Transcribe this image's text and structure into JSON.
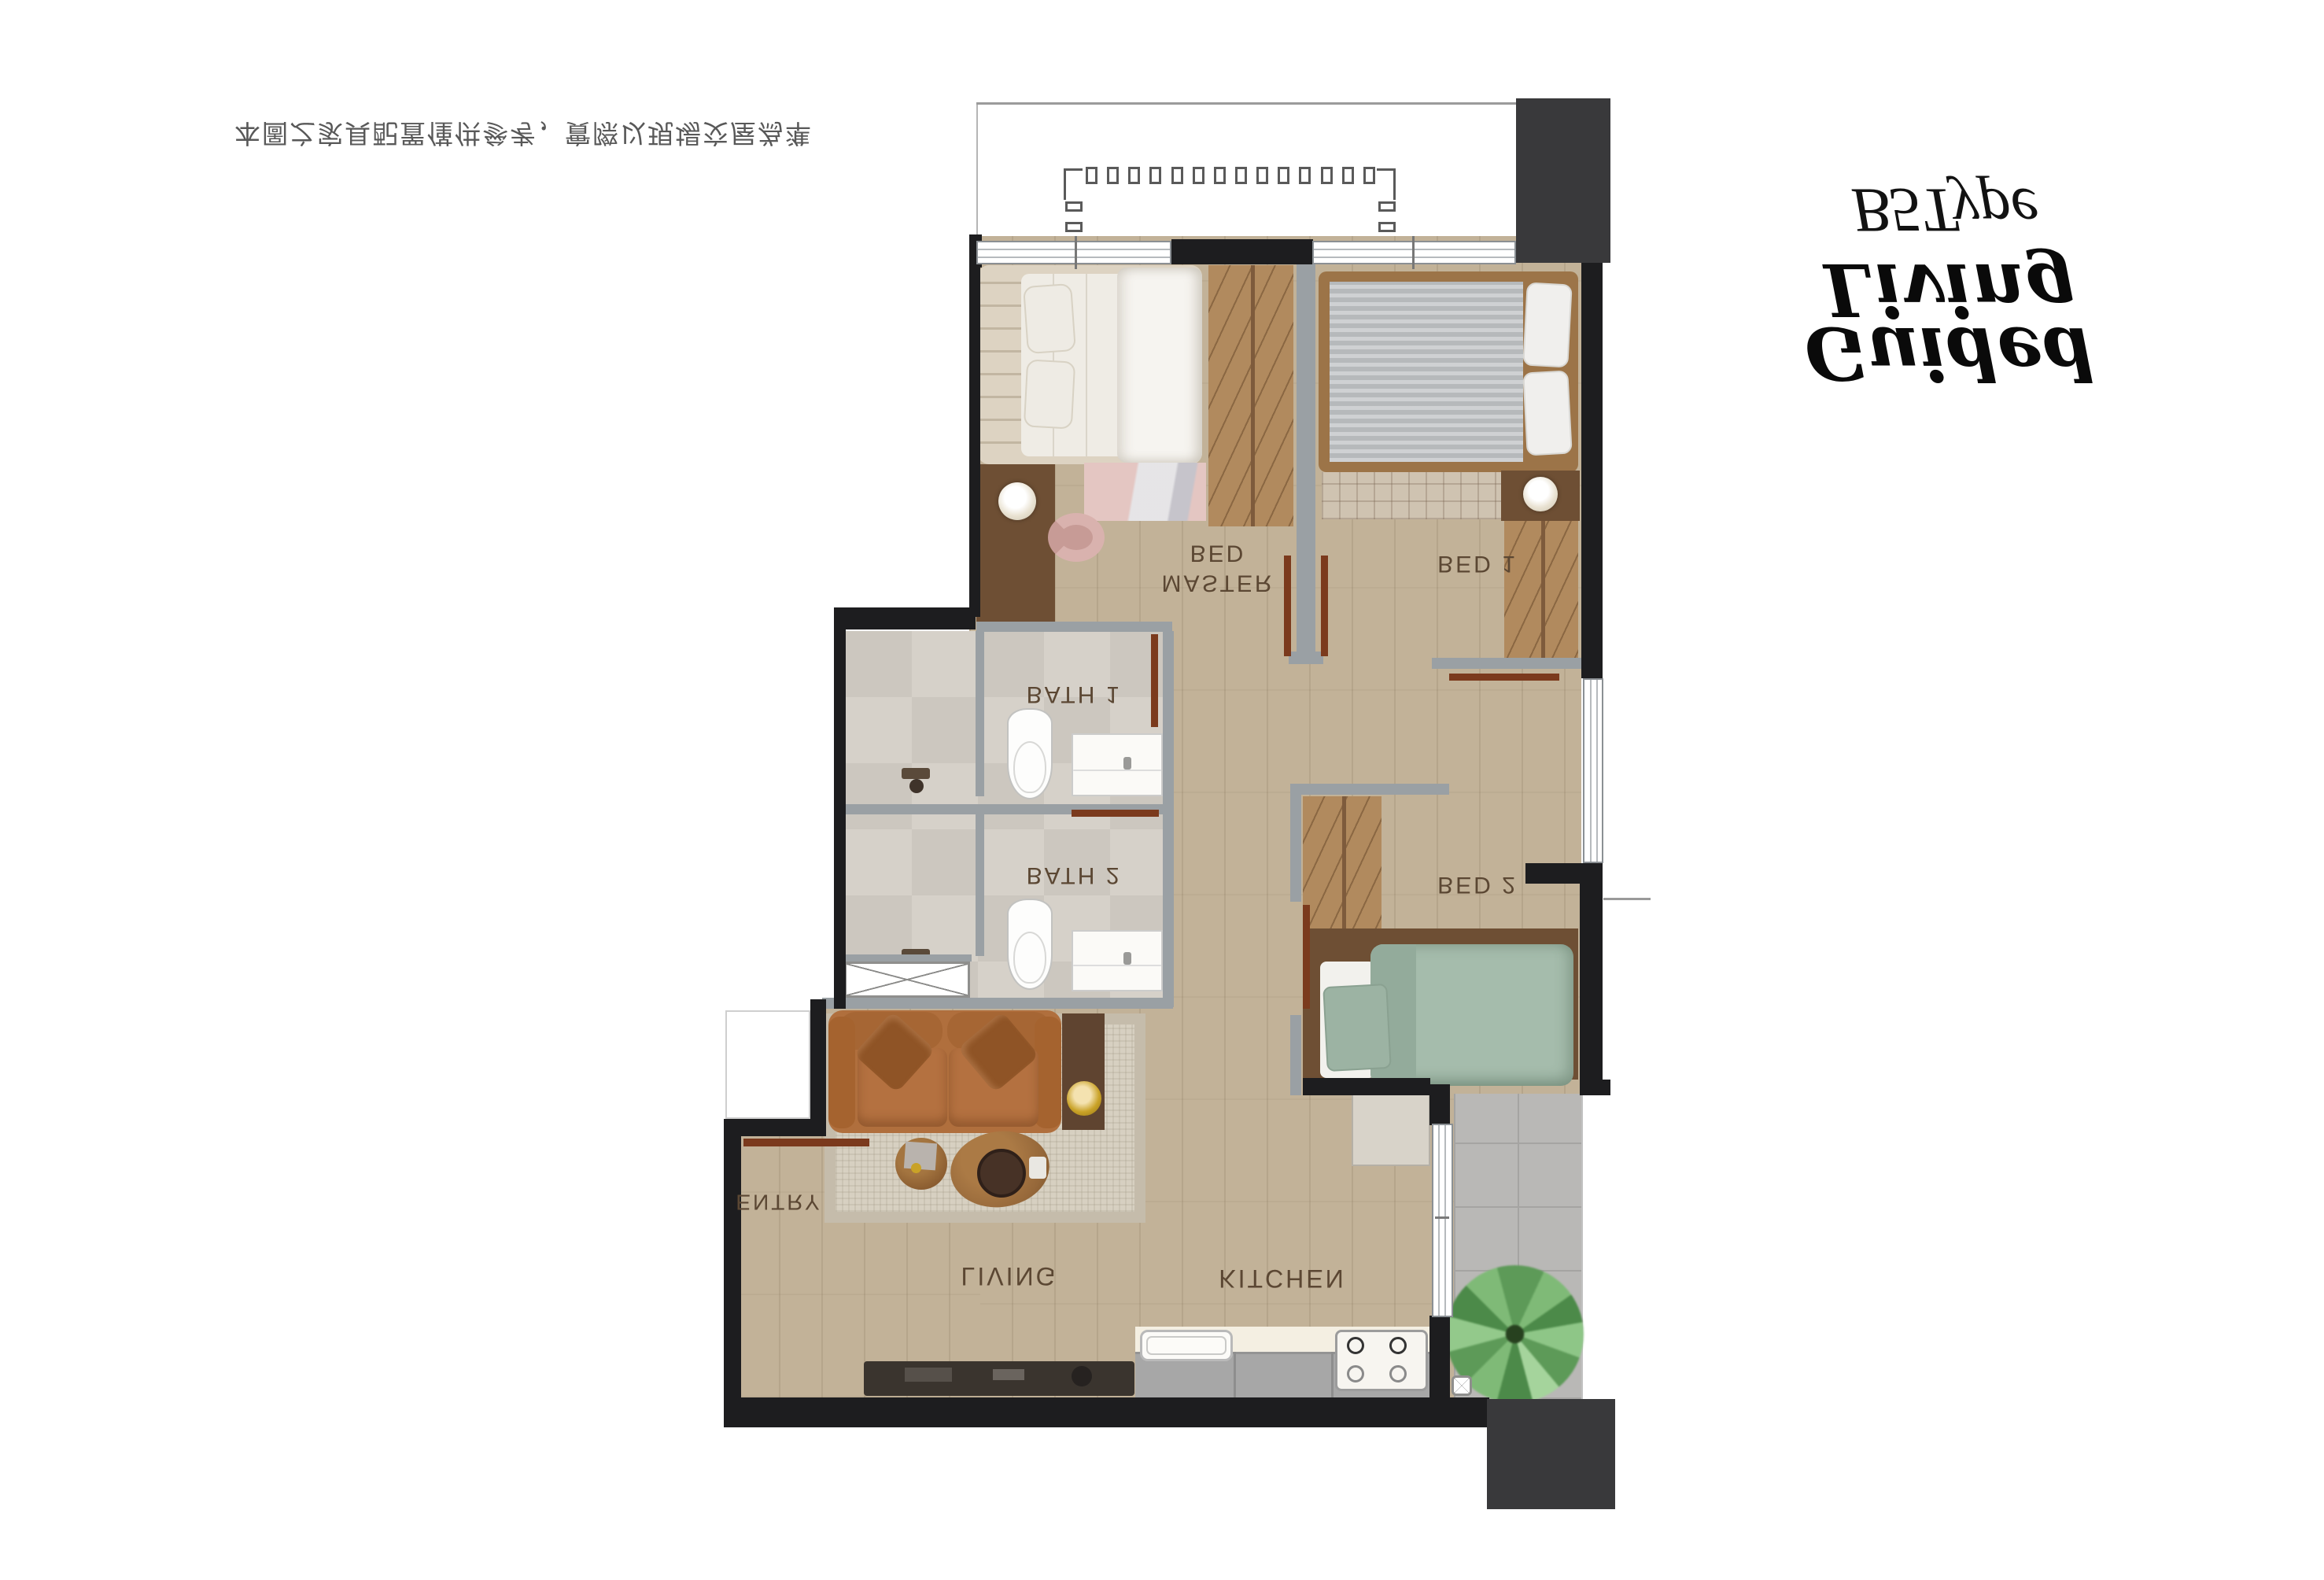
{
  "header": {
    "unit_type": "B5Type",
    "brand_line1": "Guided",
    "brand_line2": "Living",
    "disclaimer": "本圖之家具配置僅供參考，實際以現場交屋為準"
  },
  "labels": {
    "master_line1": "MASTER",
    "master_line2": "BED",
    "bed1": "BED 1",
    "bed2": "BED 2",
    "bath1": "BATH 1",
    "bath2": "BATH 2",
    "living": "LIVING",
    "kitchen": "KITCHEN",
    "entry": "ENTRY"
  },
  "colors": {
    "wall_black": "#1d1d1f",
    "wall_dark": "#39393b",
    "wall_gray": "#9aa0a4",
    "wood": "#c2b298",
    "tile_bath": "#d3cec6",
    "tile_balcony": "#b9b8b6",
    "door_brown": "#7b3a1d",
    "wardrobe_tan": "#b18a5e",
    "platform_brown": "#6e4f34",
    "sofa_cognac": "#b06f3d",
    "bed2_sage": "#a5bcac",
    "bed1_gray": "#b6b9bb",
    "master_cream": "#efece5",
    "rug_beige": "#d7d0c1",
    "rug_pink": "#e4c6c2",
    "counter_cream": "#f4efe2",
    "cabinet_gray": "#a7a7a7",
    "lamp_gold": "#c9a227",
    "plant_green": "#6fae68",
    "label_brown": "#5b4733"
  }
}
